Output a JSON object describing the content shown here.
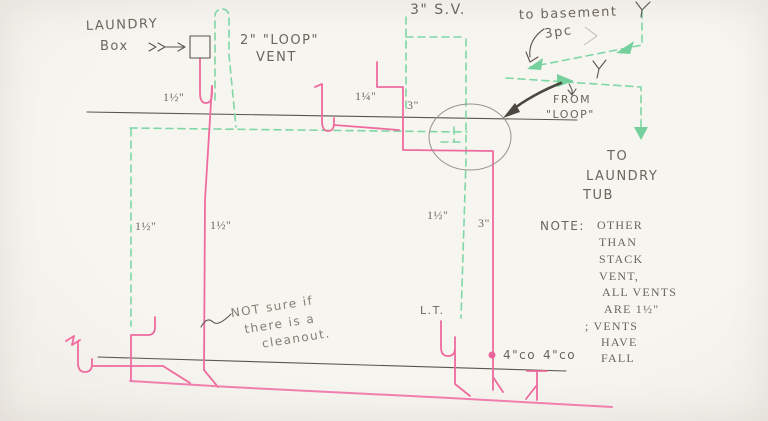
{
  "sketch": {
    "kind": "hand-drawn plumbing drain-vent diagram",
    "colors": {
      "pipe_pink": "#ee6b9e",
      "vent_green": "#7fd7a5",
      "pencil": "#6b655c",
      "paper": "#f6f4ef"
    },
    "laundry_box": {
      "line1": "LAUNDRY",
      "line2": "Box"
    },
    "loop_vent": {
      "line1": "2\" \"LOOP\"",
      "line2": "VENT"
    },
    "stack_vent": {
      "label": "3\" S.V."
    },
    "basement": {
      "label": "to basement",
      "sublabel": "3pc"
    },
    "from_loop": {
      "line1": "FROM",
      "line2": "\"LOOP\""
    },
    "laundry_tub": {
      "line1": "TO",
      "line2": "LAUNDRY",
      "line3": "TUB",
      "abbrev": "L.T."
    },
    "cleanouts": {
      "left": "4\"co",
      "right": "4\"co"
    },
    "note": {
      "heading": "NOTE:",
      "lines": [
        "OTHER",
        "THAN",
        "STACK",
        "VENT,",
        "ALL VENTS",
        "ARE 1½\"",
        "; VENTS",
        "HAVE",
        "FALL"
      ]
    },
    "cleanout_note": {
      "line1": "NOT sure if",
      "line2": "there is a",
      "line3": "cleanout."
    },
    "pipe_sizes": {
      "laundry_trap": "1½\"",
      "mid_fixture": "1¼\"",
      "stack_upper": "3\"",
      "left_vent": "1½\"",
      "laundry_drain": "1½\"",
      "right_vent": "1½\"",
      "stack_lower": "3\""
    }
  }
}
